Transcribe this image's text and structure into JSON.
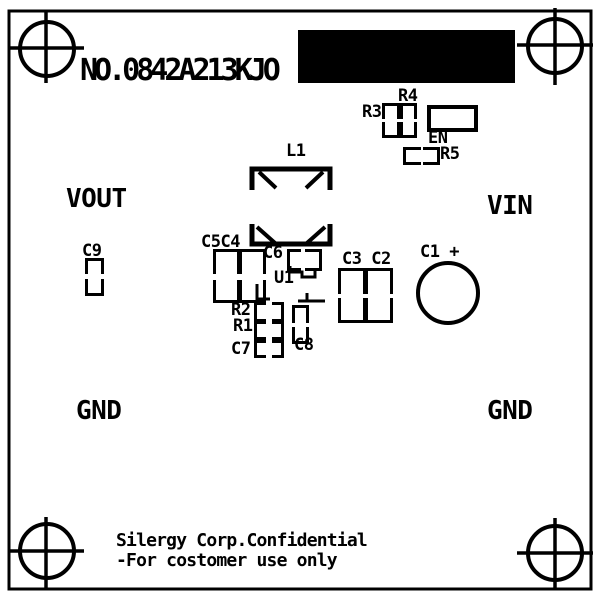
{
  "title": "NO.0842A213KJO",
  "ports": {
    "vout": "VOUT",
    "vin": "VIN",
    "gnd_left": "GND",
    "gnd_right": "GND"
  },
  "components": {
    "l1": "L1",
    "c9": "C9",
    "c5c4": "C5C4",
    "c6": "C6",
    "u1": "U1",
    "c3c2": "C3 C2",
    "c1": "C1 +",
    "r2": "R2",
    "r1": "R1",
    "c7": "C7",
    "c8": "C8",
    "r3": "R3",
    "r4": "R4",
    "en": "EN",
    "r5": "R5"
  },
  "footer": {
    "line1": "Silergy Corp.Confidential",
    "line2": "-For costomer use only"
  },
  "icons": {
    "mounting_hole": "crosshair-circle",
    "polarity_mark": "plus"
  },
  "colors": {
    "silkscreen": "#000000",
    "board_background": "#ffffff",
    "label_area_fill": "#000000"
  }
}
